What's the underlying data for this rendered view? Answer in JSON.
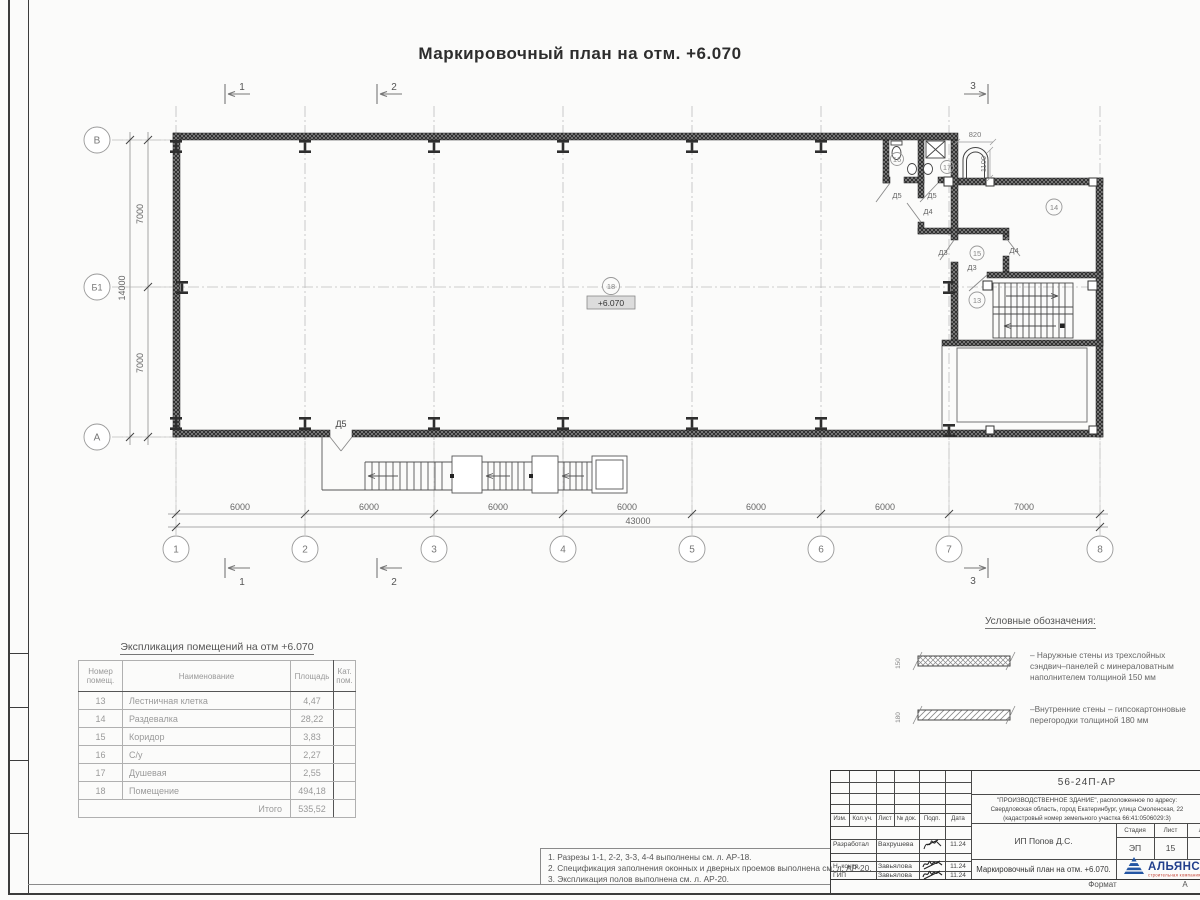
{
  "sheet": {
    "title": "Маркировочный план на отм. +6.070",
    "format_label": "Формат",
    "format_value": "А"
  },
  "plan": {
    "elevation_mark": "+6.070",
    "axes_bottom": [
      "1",
      "2",
      "3",
      "4",
      "5",
      "6",
      "7",
      "8"
    ],
    "axes_left": [
      "В",
      "Б1",
      "А"
    ],
    "dims_bottom": [
      "6000",
      "6000",
      "6000",
      "6000",
      "6000",
      "6000",
      "7000"
    ],
    "dim_total_bottom": "43000",
    "dims_left": [
      "7000",
      "7000"
    ],
    "dim_total_left": "14000",
    "dim_recess_width": "820",
    "dim_recess_height": "1100",
    "sections": [
      "1",
      "2",
      "3"
    ],
    "doors": {
      "d3": "Д3",
      "d4": "Д4",
      "d5": "Д5"
    }
  },
  "explication": {
    "heading": "Экспликация помещений на отм +6.070",
    "columns": [
      "Номер помещ.",
      "Наименование",
      "Площадь",
      "Кат. пом."
    ],
    "rows": [
      {
        "num": "13",
        "name": "Лестничная клетка",
        "area": "4,47"
      },
      {
        "num": "14",
        "name": "Раздевалка",
        "area": "28,22"
      },
      {
        "num": "15",
        "name": "Коридор",
        "area": "3,83"
      },
      {
        "num": "16",
        "name": "С/у",
        "area": "2,27"
      },
      {
        "num": "17",
        "name": "Душевая",
        "area": "2,55"
      },
      {
        "num": "18",
        "name": "Помещение",
        "area": "494,18"
      }
    ],
    "total_label": "Итого",
    "total_area": "535,52"
  },
  "legend": {
    "heading": "Условные обозначения:",
    "items": [
      {
        "dim": "150",
        "text": "– Наружные стены из трехслойных сэндвич–панелей с минераловатным наполнителем толщиной 150 мм"
      },
      {
        "dim": "180",
        "text": "–Внутренние стены – гипсокартонновые перегородки толщиной 180 мм"
      }
    ]
  },
  "notes": [
    "1. Разрезы 1-1, 2-2, 3-3, 4-4 выполнены см. л. АР-18.",
    "2. Спецификация заполнения оконных и дверных проемов выполнена см. л. АР-20.",
    "3. Экспликация полов выполнена см. л. АР-20."
  ],
  "titleblock": {
    "doc_code": "56-24П-АР",
    "project_line1": "\"ПРОИЗВОДСТВЕННОЕ ЗДАНИЕ\", расположенное по адресу:",
    "project_line2": "Свердловская область, город Екатеринбург, улица Смоленская, 22",
    "project_line3": "(кадастровый номер земельного участка 66:41:0506029:3)",
    "client": "ИП Попов Д.С.",
    "columns": [
      "Изм.",
      "Кол.уч.",
      "Лист",
      "№ док.",
      "Подп.",
      "Дата"
    ],
    "stage_label": "Стадия",
    "sheet_label": "Лист",
    "sheets_label": "Листов",
    "stage": "ЭП",
    "sheet_no": "15",
    "sheets_total": "2",
    "drawing_title": "Маркировочный план на отм. +6.070.",
    "roles": [
      {
        "role": "Разработал",
        "name": "Вахрушева",
        "date": "11.24"
      },
      {
        "role": "Н. контр.",
        "name": "Завьялова",
        "date": "11.24"
      },
      {
        "role": "ГИП",
        "name": "Завьялова",
        "date": "11.24"
      }
    ],
    "logo_text": "АЛЬЯНС",
    "logo_sub": "строительная компания"
  }
}
